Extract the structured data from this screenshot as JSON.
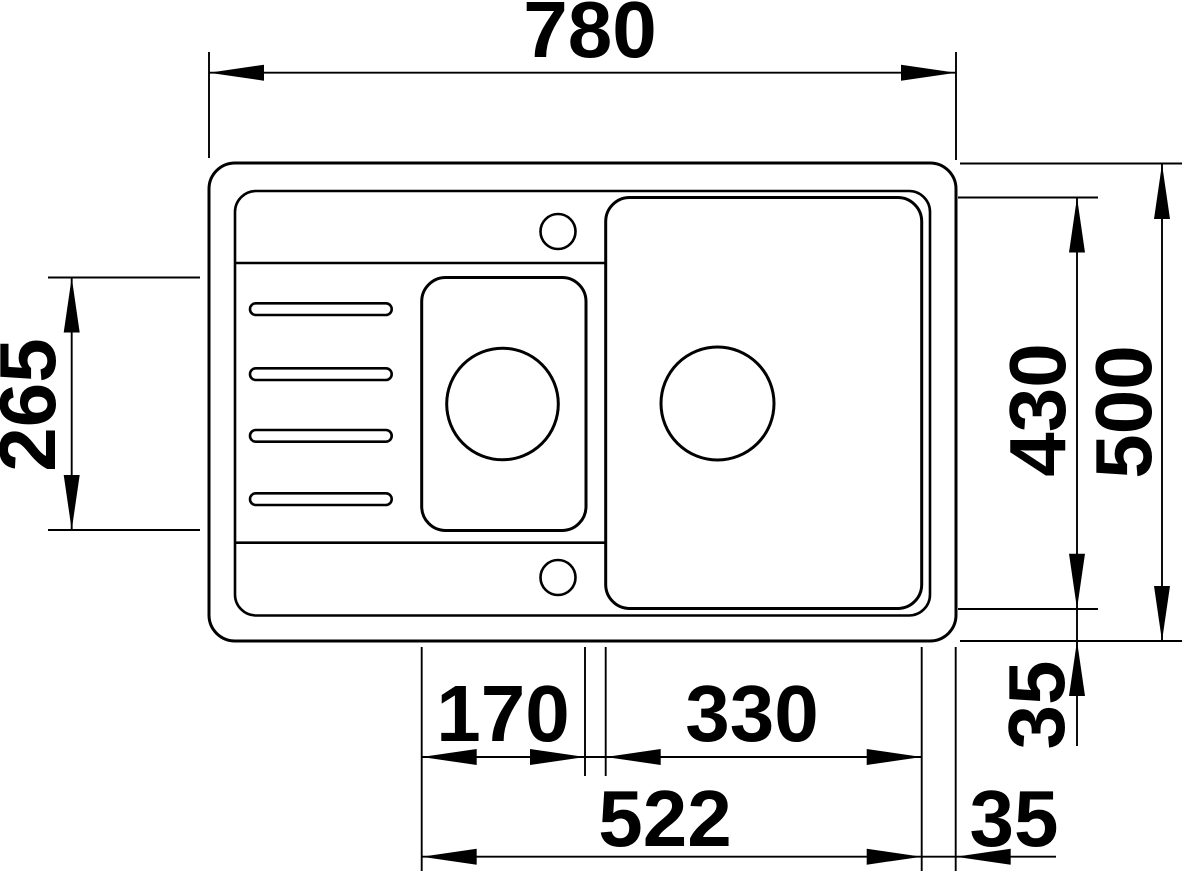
{
  "labels": {
    "overall_width": "780",
    "overall_depth": "500",
    "bowl_zone_depth": "430",
    "small_bowl_depth": "265",
    "small_bowl_width": "170",
    "main_bowl_width": "330",
    "bowls_span": "522",
    "bowl_bottom_edge_gap": "35",
    "bowl_right_edge_gap": "35"
  },
  "colors": {
    "line": "#000000",
    "background": "#ffffff"
  }
}
